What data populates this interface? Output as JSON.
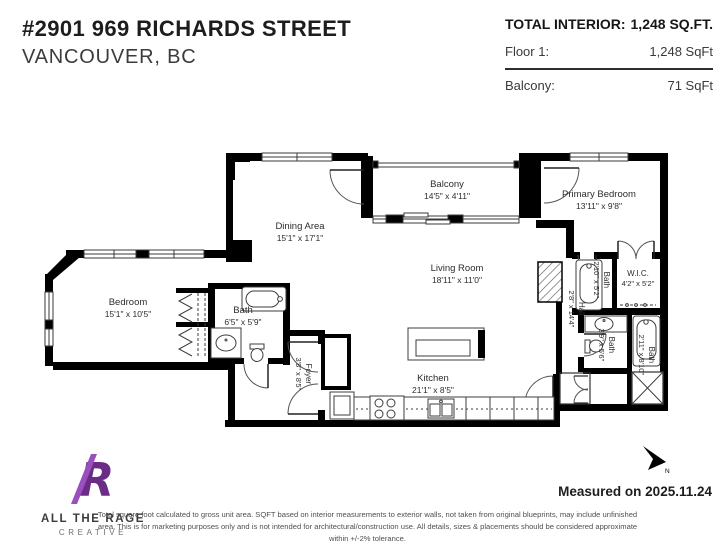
{
  "header": {
    "title": "#2901 969 RICHARDS STREET",
    "subtitle": "VANCOUVER, BC"
  },
  "summary": {
    "total_label": "TOTAL INTERIOR:",
    "total_value": "1,248 SQ.FT.",
    "rows": [
      {
        "label": "Floor 1:",
        "value": "1,248 SqFt"
      },
      {
        "label": "Balcony:",
        "value": "71 SqFt"
      }
    ]
  },
  "rooms": [
    {
      "id": "balcony",
      "name": "Balcony",
      "dims": "14'5\" x 4'11\""
    },
    {
      "id": "primary-bedroom",
      "name": "Primary Bedroom",
      "dims": "13'11\" x 9'8\""
    },
    {
      "id": "dining-area",
      "name": "Dining Area",
      "dims": "15'1\" x 17'1\""
    },
    {
      "id": "living-room",
      "name": "Living Room",
      "dims": "18'11\" x 11'0\""
    },
    {
      "id": "bedroom",
      "name": "Bedroom",
      "dims": "15'1\" x 10'5\""
    },
    {
      "id": "bath-main",
      "name": "Bath",
      "dims": "6'5\" x 5'9\""
    },
    {
      "id": "kitchen",
      "name": "Kitchen",
      "dims": "21'1\" x 8'5\""
    },
    {
      "id": "hall",
      "name": "Hall",
      "dims": "2'8\" x 14'4\""
    },
    {
      "id": "bath-ensuite",
      "name": "Bath",
      "dims": "2'10\" x 5'2\""
    },
    {
      "id": "wic",
      "name": "W.I.C.",
      "dims": "4'2\" x 5'2\""
    },
    {
      "id": "bath-center",
      "name": "Bath",
      "dims": "3'9\" x 5'6\""
    },
    {
      "id": "bath-right",
      "name": "Bath",
      "dims": "2'11\" x 8'10\""
    },
    {
      "id": "foyer",
      "name": "Foyer",
      "dims": "3'8\" x 8'5\""
    }
  ],
  "compass": {
    "label": "N"
  },
  "footer": {
    "logo_monogram": "R",
    "logo_line1": "ALL THE RAGE",
    "logo_line2": "CREATIVE",
    "measured": "Measured on 2025.11.24",
    "disclaimer": "Total square foot calculated to gross unit area. SQFT based on interior measurements to exterior walls, not taken from original blueprints, may include unfinished area. This is for marketing purposes only and is not intended for architectural/construction use.  All details, sizes & placements should be considered approximate within +/-2% tolerance."
  },
  "colors": {
    "wall": "#000000",
    "brand_purple": "#7b3f98",
    "brand_purple_light": "#9a4fbe"
  }
}
